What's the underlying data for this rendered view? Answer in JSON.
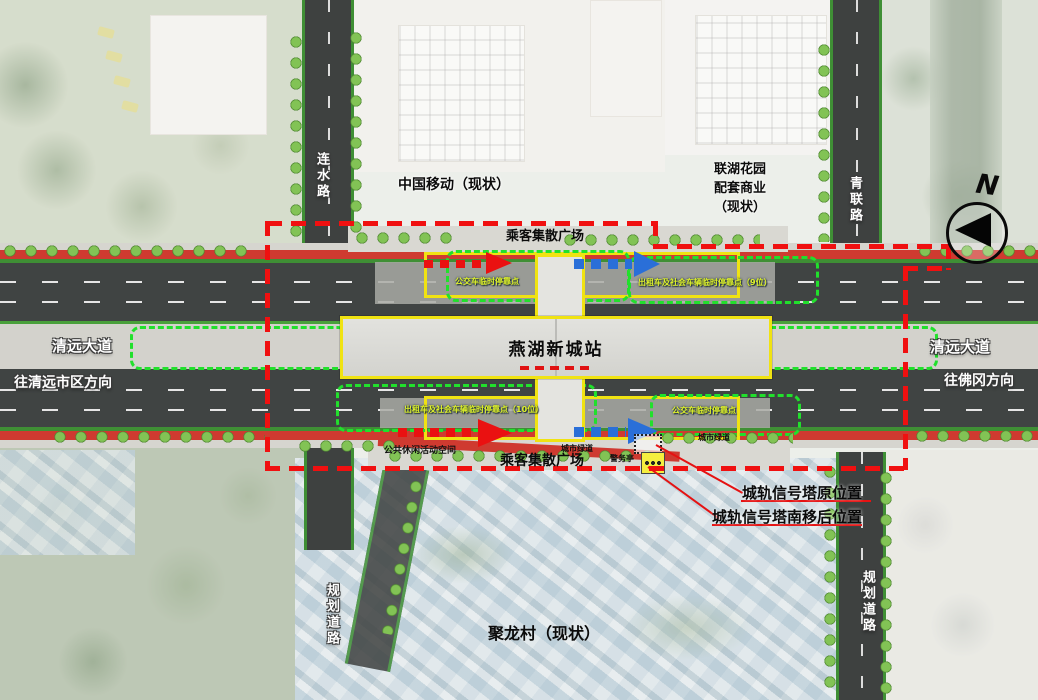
{
  "map": {
    "station_label": "燕湖新城站",
    "north_plaza": "乘客集散广场",
    "south_plaza": "乘客集散广场",
    "buildings": {
      "china_mobile": "中国移动（现状）",
      "lianhu_line1": "联湖花园",
      "lianhu_line2": "配套商业",
      "lianhu_line3": "（现状）",
      "village": "聚龙村（现状）"
    },
    "roads": {
      "lianshui_road": "连水路",
      "qinglian_road": "青联路",
      "qingyuan_ave_west": "清远大道",
      "qingyuan_ave_east": "清远大道",
      "to_qingyuan_downtown": "往清远市区方向",
      "to_fogang": "往佛冈方向",
      "planned_road_southwest": "规划道路",
      "planned_road_southeast": "规划道路"
    },
    "stops": {
      "north_bus": "公交车临时停靠点",
      "north_taxi": "出租车及社会车辆临时停靠点（9位）",
      "south_taxi": "出租车及社会车辆临时停靠点（10位）",
      "south_bus": "公交车临时停靠点"
    },
    "features": {
      "greenway_west": "城市绿道",
      "greenway_east": "城市绿道",
      "leisure_space": "公共休闲活动空间",
      "police_kiosk": "警务亭"
    },
    "annotations": {
      "signal_tower_original": "城轨信号塔原位置",
      "signal_tower_relocated": "城轨信号塔南移后位置"
    },
    "compass": {
      "n": "N"
    },
    "colors": {
      "boundary_red": "#f01010",
      "parking_green": "#21e02c",
      "station_outline_yellow": "#f0e312",
      "greenway_red": "#cf3a30",
      "flow_blue": "#2a6fd8",
      "stop_label_green": "#e0f32a"
    }
  }
}
